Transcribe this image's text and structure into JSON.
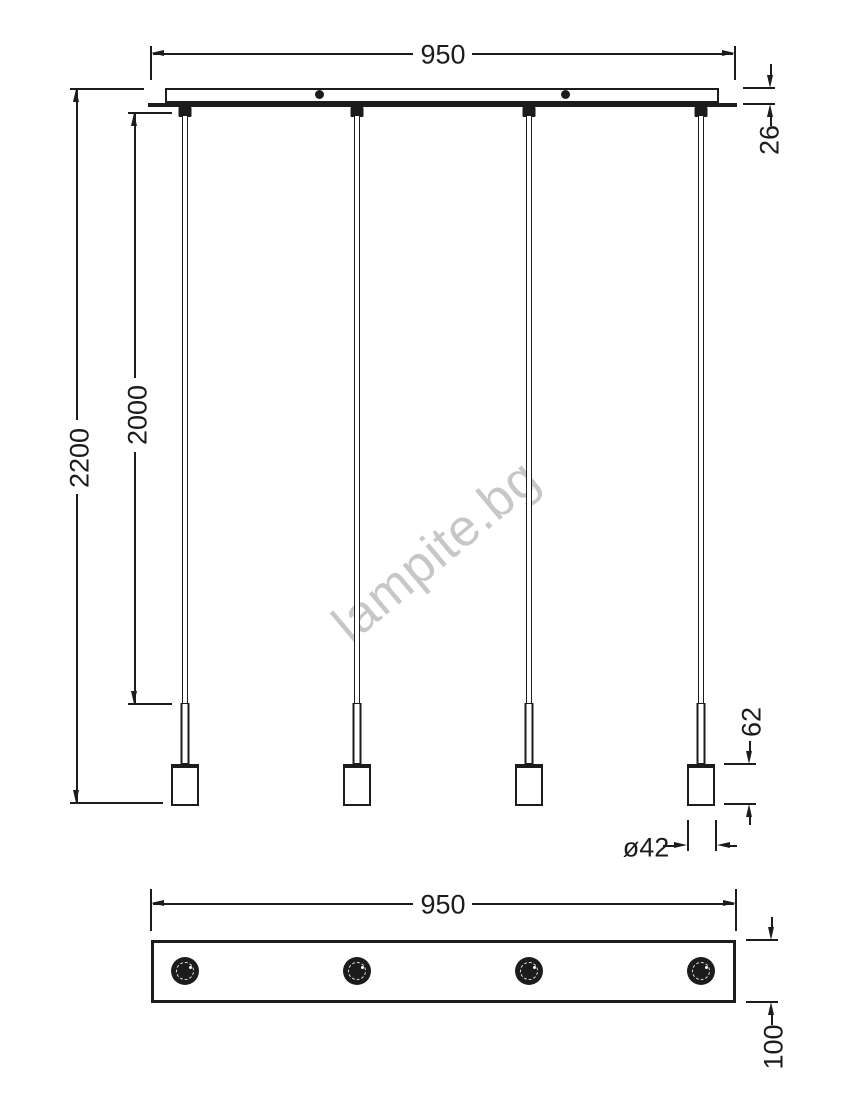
{
  "watermark": {
    "text": "lampite.bg"
  },
  "top_view": {
    "width": "950",
    "overall_height": "2200",
    "suspension_length": "2000",
    "canopy_thickness": "26",
    "socket_height": "62",
    "socket_diameter": "ø42"
  },
  "bottom_view": {
    "width": "950",
    "canopy_depth": "100"
  },
  "colors": {
    "line": "#1c1c1c",
    "watermark": "#c7c7c7",
    "background": "#ffffff"
  }
}
